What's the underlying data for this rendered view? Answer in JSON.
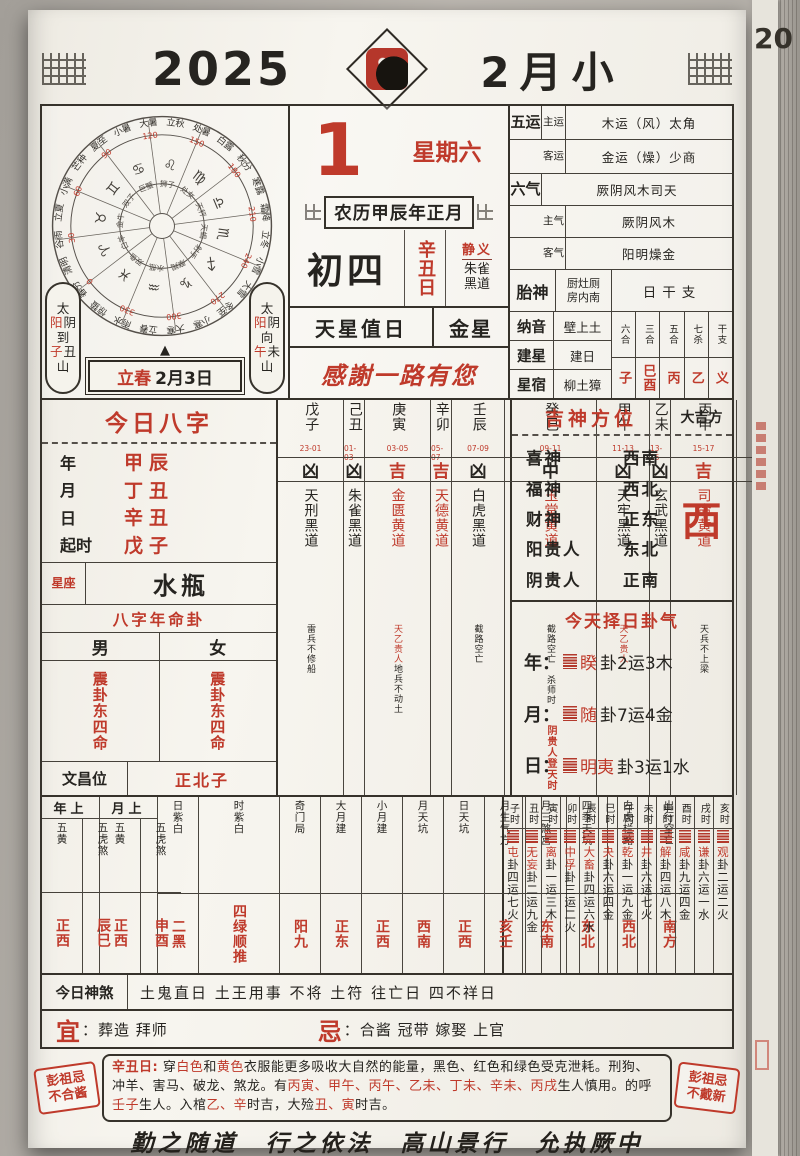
{
  "colors": {
    "accent_red": "#bf3a2b",
    "ink": "#262420",
    "page_bg": "#f4f2ec",
    "photo_bg": "#b6b2ac"
  },
  "icons": {
    "triangle_up": "▲"
  },
  "header": {
    "year": "2025",
    "month": "2月小"
  },
  "edge": {
    "hint": "20"
  },
  "date": {
    "day": "1",
    "weekday": "星期六",
    "lunar_line": "农历甲辰年正月",
    "lunar_day": "初四",
    "day_pillar": "辛丑日",
    "officer": "静义",
    "path1": "朱雀",
    "path2": "黑道",
    "star_label": "天星值日",
    "star": "金星",
    "greeting": "感謝一路有您"
  },
  "wheel": {
    "terms": [
      "小暑",
      "大暑",
      "立秋",
      "处暑",
      "白露",
      "秋分",
      "寒露",
      "霜降",
      "立冬",
      "小雪",
      "大雪",
      "冬至",
      "小寒",
      "大寒",
      "立春",
      "雨水",
      "惊蛰",
      "春分",
      "清明",
      "谷雨",
      "立夏",
      "小满",
      "芒种",
      "夏至"
    ],
    "degrees": [
      "0",
      "30",
      "60",
      "90",
      "120",
      "150",
      "180",
      "210",
      "240",
      "270",
      "300",
      "330"
    ],
    "zodiac_symbols": [
      "♈",
      "♉",
      "♊",
      "♋",
      "♌",
      "♍",
      "♎",
      "♏",
      "♐",
      "♑",
      "♒",
      "♓"
    ],
    "zodiac_names": [
      "白羊",
      "金牛",
      "双子",
      "巨蟹",
      "狮子",
      "处女",
      "天秤",
      "天蝎",
      "射手",
      "摩羯",
      "水瓶",
      "双鱼"
    ]
  },
  "capsule_left": {
    "a": "太",
    "sun": "阳",
    "moon": "阴",
    "verb": "到",
    "r1": "子",
    "r2": "丑",
    "tail": "山"
  },
  "capsule_right": {
    "a": "太",
    "sun": "阳",
    "moon": "阴",
    "verb": "向",
    "r1": "午",
    "r2": "未",
    "tail": "山"
  },
  "banner": {
    "term": "立春",
    "date": "2月3日"
  },
  "panel": {
    "wuyun_label": "五运",
    "wuyun": [
      {
        "k": "主运",
        "v": "木运（风）太角"
      },
      {
        "k": "客运",
        "v": "金运（燥）少商"
      }
    ],
    "liuqi_label": "六气",
    "liuqi_top": "厥阴风木司天",
    "liuqi": [
      {
        "k": "主气",
        "v": "厥阴风木"
      },
      {
        "k": "客气",
        "v": "阳明燥金"
      }
    ],
    "taishen_label": "胎神",
    "taishen1": "厨灶厕",
    "taishen2": "房内南",
    "ganzhi_title": "日干支",
    "ganzhi_cols": [
      {
        "k": "六合",
        "v": "子"
      },
      {
        "k": "三合",
        "v": "巳酉"
      },
      {
        "k": "五合",
        "v": "丙"
      },
      {
        "k": "七杀",
        "v": "乙"
      },
      {
        "k": "干支",
        "v": "义"
      }
    ],
    "nayin_label": "纳音",
    "nayin": "壁上土",
    "jianxing_label": "建星",
    "jianxing": "建日",
    "xingxiu_label": "星宿",
    "xingxiu": "柳土獐"
  },
  "bazi": {
    "title": "今日八字",
    "pillars": [
      {
        "k": "年",
        "v": "甲辰"
      },
      {
        "k": "月",
        "v": "丁丑"
      },
      {
        "k": "日",
        "v": "辛丑"
      },
      {
        "k": "起时",
        "v": "戊子"
      }
    ],
    "xingzuo_label": "星座",
    "xingzuo": "水瓶",
    "minggua_title": "八字年命卦",
    "male": "男",
    "female": "女",
    "male_gua": "震卦东四命",
    "female_gua": "震卦东四命",
    "wenchang_label": "文昌位",
    "wenchang": "正北子"
  },
  "hours": [
    {
      "stem": "戊子",
      "time": "23-01",
      "luck": "凶",
      "name": "天刑黑道",
      "note": "",
      "note2": "雷兵不修船",
      "foot": ""
    },
    {
      "stem": "己丑",
      "time": "01-03",
      "luck": "凶",
      "name": "朱雀黑道",
      "note": "",
      "note2": "",
      "foot": ""
    },
    {
      "stem": "庚寅",
      "time": "03-05",
      "luck": "吉",
      "name": "金匮黄道",
      "note": "天乙贵人",
      "note2": "地兵不动土",
      "foot": ""
    },
    {
      "stem": "辛卯",
      "time": "05-07",
      "luck": "吉",
      "name": "天德黄道",
      "note": "",
      "note2": "",
      "foot": ""
    },
    {
      "stem": "壬辰",
      "time": "07-09",
      "luck": "凶",
      "name": "白虎黑道",
      "note": "",
      "note2": "截路空亡",
      "foot": ""
    },
    {
      "stem": "癸巳",
      "time": "09-11",
      "luck": "中",
      "name": "玉堂黄道",
      "note": "",
      "note2": "截路空亡 杀师时",
      "foot": "阴贵人登天时"
    },
    {
      "stem": "甲午",
      "time": "11-13",
      "luck": "凶",
      "name": "天牢黑道",
      "note": "天乙贵人",
      "note2": "",
      "foot": ""
    },
    {
      "stem": "乙未",
      "time": "13-15",
      "luck": "凶",
      "name": "玄武黑道",
      "note": "",
      "note2": "",
      "foot": ""
    },
    {
      "stem": "丙申",
      "time": "15-17",
      "luck": "吉",
      "name": "司命黄道",
      "note": "",
      "note2": "天兵不上梁",
      "foot": ""
    },
    {
      "stem": "丁酉",
      "time": "17-19",
      "luck": "凶",
      "name": "勾陈黑道",
      "note": "",
      "note2": "五不遇时",
      "foot": "阳贵人登天时"
    },
    {
      "stem": "戊戌",
      "time": "19-21",
      "luck": "吉",
      "name": "青龙黄道",
      "note": "",
      "note2": "",
      "foot": ""
    },
    {
      "stem": "己亥",
      "time": "21-23",
      "luck": "中",
      "name": "明堂黄道",
      "note": "",
      "note2": "罗天退时 杀师时",
      "foot": ""
    }
  ],
  "jishen": {
    "title": "吉神方位",
    "daji_label": "大吉方",
    "rows": [
      {
        "k": "喜神",
        "v": "西南"
      },
      {
        "k": "福神",
        "v": "西北"
      },
      {
        "k": "财神",
        "v": "正东"
      },
      {
        "k": "阳贵人",
        "v": "东北"
      },
      {
        "k": "阴贵人",
        "v": "正南"
      }
    ],
    "daji": "西"
  },
  "guaqi": {
    "title": "今天择日卦气",
    "rows": [
      {
        "k": "年：",
        "gua": "睽",
        "rest": "卦2运3木"
      },
      {
        "k": "月：",
        "gua": "随",
        "rest": "卦7运4金"
      },
      {
        "k": "日：",
        "gua": "明夷",
        "rest": "卦3运1水"
      }
    ]
  },
  "directions": {
    "year_group": "年上",
    "month_group": "月上",
    "cols": [
      {
        "h": "五黄",
        "v": "正西"
      },
      {
        "h": "五虎煞",
        "v": "辰巳"
      },
      {
        "h": "五黄",
        "v": "正西"
      },
      {
        "h": "五虎煞",
        "v": "申酉"
      },
      {
        "h": "日紫白",
        "v": "二黑"
      },
      {
        "h": "时紫白",
        "v": "四绿顺推"
      },
      {
        "h": "奇门局",
        "v": "阳九"
      },
      {
        "h": "大月建",
        "v": "正东"
      },
      {
        "h": "小月建",
        "v": "正西"
      },
      {
        "h": "月天坑",
        "v": "西南"
      },
      {
        "h": "日天坑",
        "v": "正西"
      },
      {
        "h": "月生气方",
        "v": "亥壬"
      },
      {
        "h": "月三煞宫",
        "v": "东南"
      },
      {
        "h": "四季天坑",
        "v": "东北"
      },
      {
        "h": "白虎栏路",
        "v": "西北"
      },
      {
        "h": "出行空亡",
        "v": "南方"
      }
    ]
  },
  "hour_gua": [
    {
      "h": "子时",
      "gua": "屯",
      "rest": "卦四运七火"
    },
    {
      "h": "丑时",
      "gua": "无妄",
      "rest": "卦二运九金"
    },
    {
      "h": "寅时",
      "gua": "离",
      "rest": "卦一运三木"
    },
    {
      "h": "卯时",
      "gua": "中孚",
      "rest": "卦三运二火"
    },
    {
      "h": "辰时",
      "gua": "大畜",
      "rest": "卦四运六水"
    },
    {
      "h": "巳时",
      "gua": "夬",
      "rest": "卦六运四金"
    },
    {
      "h": "午时",
      "gua": "乾",
      "rest": "卦一运九金"
    },
    {
      "h": "未时",
      "gua": "井",
      "rest": "卦六运七火"
    },
    {
      "h": "申时",
      "gua": "解",
      "rest": "卦四运八木"
    },
    {
      "h": "酉时",
      "gua": "咸",
      "rest": "卦九运四金"
    },
    {
      "h": "戌时",
      "gua": "谦",
      "rest": "卦六运一水"
    },
    {
      "h": "亥时",
      "gua": "观",
      "rest": "卦二运二火"
    }
  ],
  "shensha": {
    "label": "今日神煞",
    "text": "土鬼直日 土王用事 不将 土符 往亡日 四不祥日"
  },
  "yiji": {
    "yi_label": "宜",
    "ji_label": "忌",
    "colon": "：",
    "yi": "葬造 拜师",
    "ji": "合酱 冠带 嫁娶 上官"
  },
  "stamps": {
    "left1": "彭祖忌",
    "left2": "不合酱",
    "right1": "彭祖忌",
    "right2": "不戴新"
  },
  "pengzu": {
    "segs": [
      {
        "t": "辛丑日:"
      },
      {
        "t": " 穿"
      },
      {
        "t": "白色"
      },
      {
        "t": "和"
      },
      {
        "t": "黄色"
      },
      {
        "t": "衣服能更多吸收大自然的能量，黑色、红色和绿色受克泄耗。刑狗、冲羊、害马、破龙、煞龙。有"
      },
      {
        "t": "丙寅、甲午、丙午、乙未、丁未、辛未、丙戌"
      },
      {
        "t": "生人慎用。的呼"
      },
      {
        "t": "壬子"
      },
      {
        "t": "生人。入棺"
      },
      {
        "t": "乙、辛"
      },
      {
        "t": "时吉，大殓"
      },
      {
        "t": "丑、寅"
      },
      {
        "t": "时吉。"
      }
    ]
  },
  "motto": "勤之随道　行之依法　高山景行　允执厥中"
}
